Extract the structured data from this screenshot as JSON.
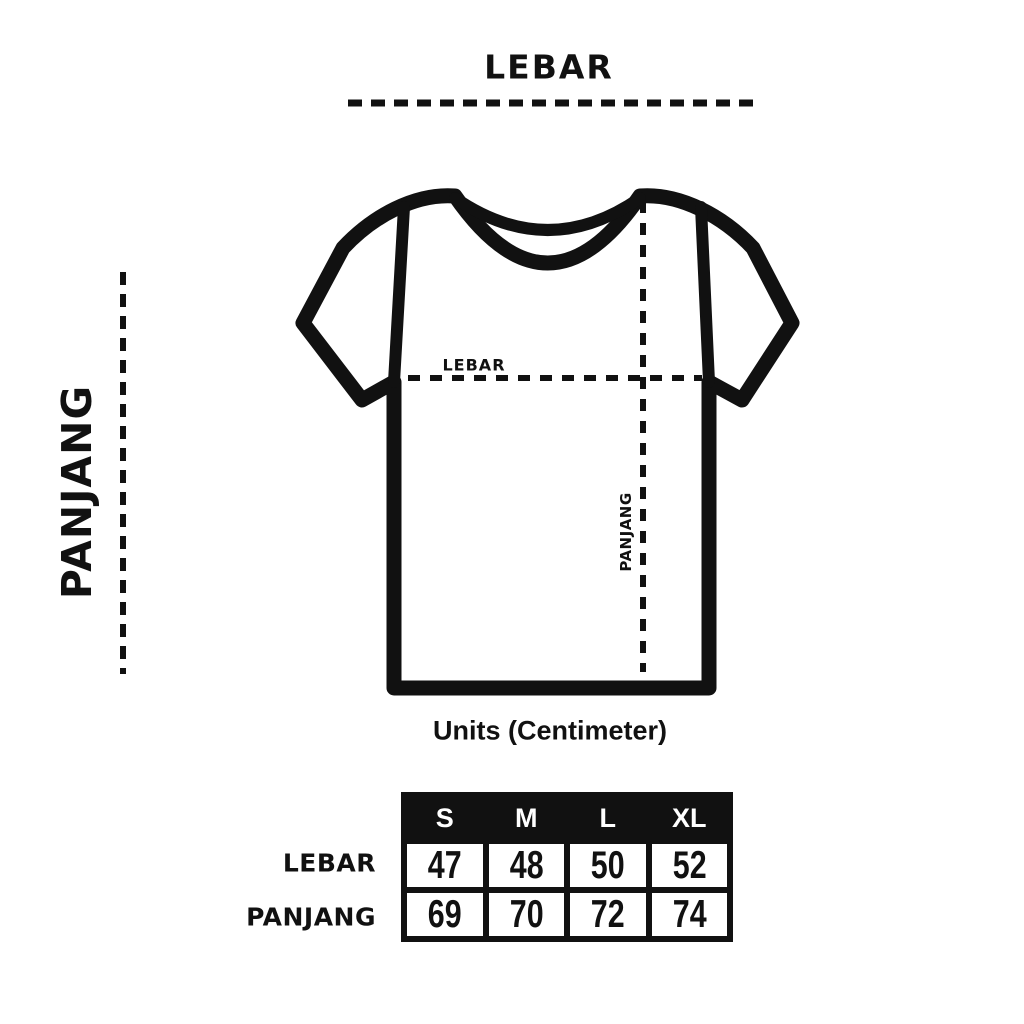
{
  "title": "LEBAR",
  "axes": {
    "length_label": "PANJANG"
  },
  "shirt": {
    "width_label": "LEBAR",
    "length_label": "PANJANG"
  },
  "caption": "Units (Centimeter)",
  "size_table": {
    "columns": [
      "S",
      "M",
      "L",
      "XL"
    ],
    "rows": [
      {
        "label": "LEBAR",
        "values": [
          "47",
          "48",
          "50",
          "52"
        ]
      },
      {
        "label": "PANJANG",
        "values": [
          "69",
          "70",
          "72",
          "74"
        ]
      }
    ]
  },
  "colors": {
    "ink": "#111111",
    "background": "#ffffff",
    "table_header_bg": "#111111",
    "table_header_text": "#ffffff"
  }
}
